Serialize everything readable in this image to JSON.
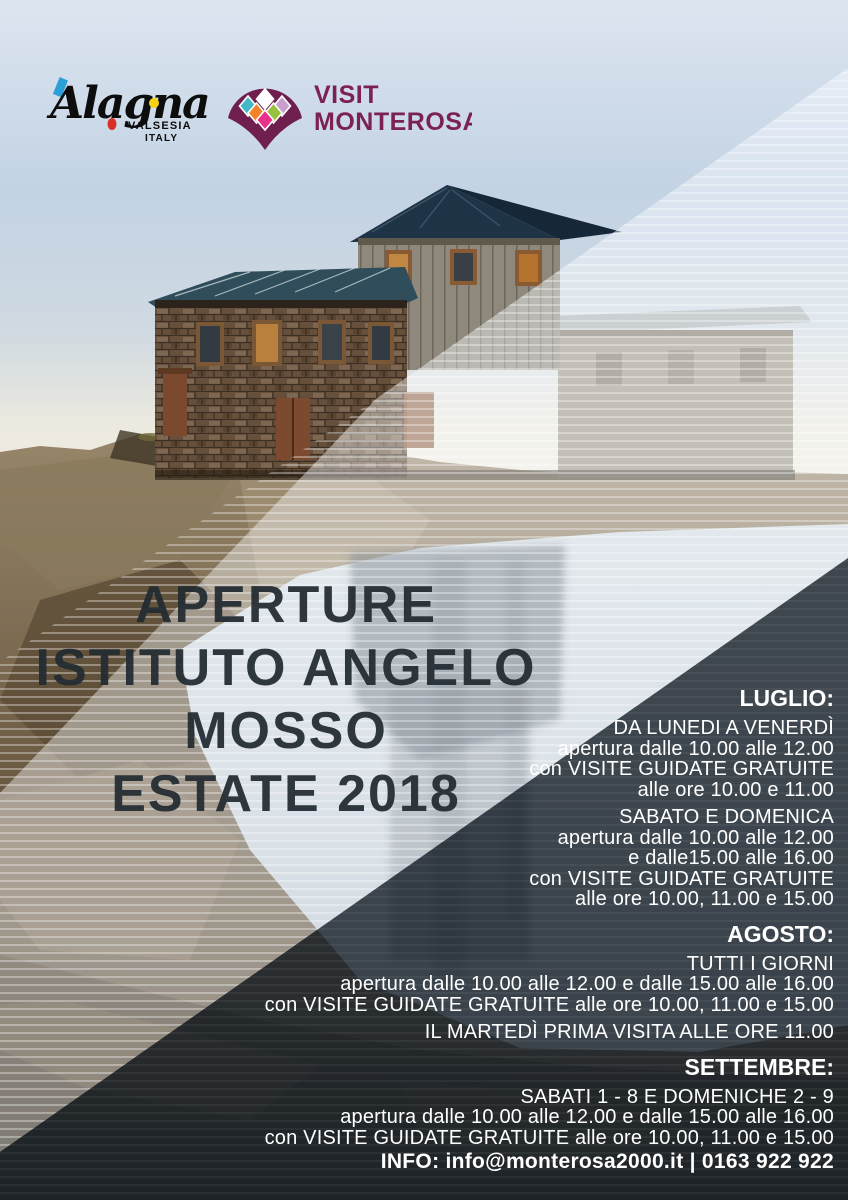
{
  "poster": {
    "logos": {
      "alagna": {
        "name": "Alagna",
        "sub1": "VALSESIA",
        "sub2": "ITALY"
      },
      "monterosa": {
        "line1": "VISIT",
        "line2": "MONTEROSA"
      }
    },
    "title": {
      "lines": [
        "APERTURE",
        "ISTITUTO ANGELO",
        "MOSSO",
        "ESTATE 2018"
      ]
    },
    "schedule": [
      {
        "header": "LUGLIO:",
        "blocks": [
          [
            "DA LUNEDI A VENERDÌ",
            "apertura dalle 10.00 alle 12.00",
            "con VISITE GUIDATE GRATUITE",
            "alle ore 10.00 e 11.00"
          ],
          [
            "SABATO E DOMENICA",
            "apertura dalle 10.00 alle 12.00",
            "e dalle15.00 alle 16.00",
            "con VISITE GUIDATE GRATUITE",
            "alle ore 10.00, 11.00 e 15.00"
          ]
        ]
      },
      {
        "header": "AGOSTO:",
        "blocks": [
          [
            "TUTTI I GIORNI",
            "apertura dalle 10.00 alle 12.00 e dalle 15.00 alle 16.00",
            "con VISITE GUIDATE GRATUITE alle ore 10.00, 11.00 e 15.00"
          ],
          [
            "IL MARTEDÌ PRIMA VISITA ALLE ORE 11.00"
          ]
        ]
      },
      {
        "header": "SETTEMBRE:",
        "blocks": [
          [
            "SABATI 1 - 8 E DOMENICHE 2 - 9",
            "apertura dalle 10.00 alle 12.00 e dalle 15.00 alle 16.00",
            "con VISITE GUIDATE GRATUITE alle ore 10.00, 11.00 e 15.00"
          ]
        ]
      }
    ],
    "info": "INFO: info@monterosa2000.it | 0163 922 922",
    "colors": {
      "plum_brand": "#6f1f4e",
      "plum_text": "#7b2153",
      "fan_teal": "#45b8c8",
      "fan_orange": "#f0832a",
      "fan_lime": "#96c23d",
      "fan_lilac": "#c9a0cc",
      "fan_magenta": "#e8318a",
      "alagna_blue": "#2d9fd8",
      "alagna_yellow": "#f5d313",
      "alagna_red": "#d93026",
      "title_text": "#232c32",
      "schedule_text": "#ffffff",
      "dark_overlay": "#1e272e",
      "sky": "#c3d3e4"
    }
  }
}
